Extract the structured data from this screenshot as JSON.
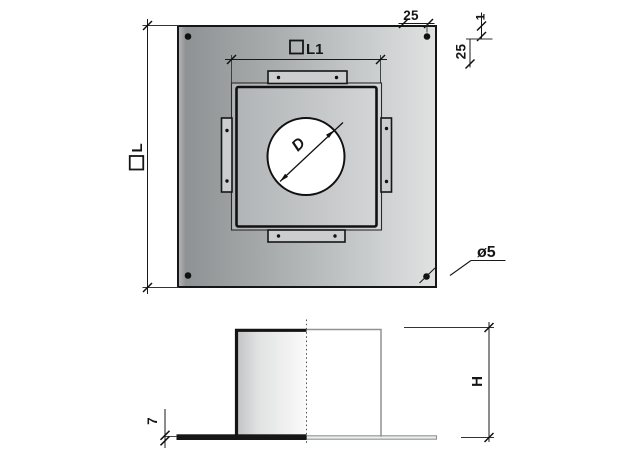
{
  "drawing": {
    "labels": {
      "plate_side_dim": "L",
      "inner_side_dim": "L1",
      "corner_hole_offset_top": "25",
      "corner_hole_offset_right": "25",
      "edge_gap_right": "1",
      "corner_hole_diameter": "ø5",
      "pipe_diameter": "D",
      "duct_height": "H",
      "plate_thickness": "7"
    },
    "symbols": {
      "square-symbol": "outlined square prefix before L and L1"
    },
    "colors": {
      "line": "#161616",
      "dim_line": "#1a1a1a",
      "ghost_line": "#8f9294",
      "plate_dark": "#8f9294",
      "plate_mid": "#a8abac",
      "plate_light": "#e0e2e2",
      "inner_dark": "#b0b3b5",
      "inner_light": "#d4d6d7",
      "tab_fill": "#cbcdce",
      "box_dark": "#c2c3c4",
      "box_light": "#fbfbfb",
      "opening_fill": "#ffffff"
    }
  }
}
